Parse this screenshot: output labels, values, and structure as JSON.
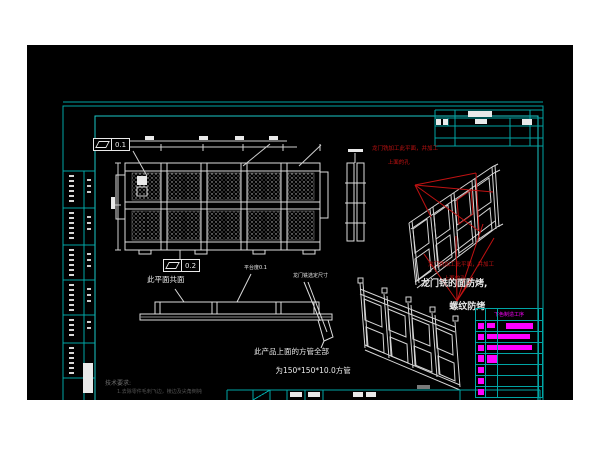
{
  "app": {
    "description": "CAD engineering drawing canvas (gantry-milled welded platform frame)"
  },
  "colors": {
    "canvas_bg": "#000000",
    "sheet_frame": "#00a5a5",
    "inner_frame": "#1ac9c9",
    "linework": "#e9e9e9",
    "annotation_red": "#c01212",
    "process_magenta": "#ff00ff",
    "tech_note_gray": "#6f6f6f"
  },
  "gdt": {
    "flatness_top": "0.1",
    "flatness_mid": "0.2"
  },
  "notes": {
    "coplanar": "此平面共面",
    "platform_flatness": "平台度0.1",
    "gantry_dim": "龙门铣选定尺寸",
    "red_note_line1": "龙门铣加工此平面，并加工",
    "red_note_line2": "上面的孔",
    "face_note_line1": "龙门铣的面防烤,",
    "face_note_line2": "螺纹防烤",
    "tube_note_line1": "此产品上面的方管全部",
    "tube_note_line2": "为150*150*10.0方管",
    "tech_req_title": "技术要求:",
    "tech_req_line": "1.去除零件毛刺飞边，棱边及尖角倒钝"
  },
  "process_table": {
    "header": "下色制造工序",
    "rows": [
      {
        "bars": [
          {
            "x": 2,
            "y": 2,
            "w": 6,
            "h": 6
          },
          {
            "x": 11,
            "y": 2,
            "w": 8,
            "h": 5
          },
          {
            "x": 30,
            "y": 2,
            "w": 27,
            "h": 6
          }
        ]
      },
      {
        "bars": [
          {
            "x": 2,
            "y": 2,
            "w": 6,
            "h": 6
          },
          {
            "x": 11,
            "y": 2,
            "w": 43,
            "h": 5
          }
        ]
      },
      {
        "bars": [
          {
            "x": 2,
            "y": 2,
            "w": 6,
            "h": 6
          },
          {
            "x": 11,
            "y": 2,
            "w": 45,
            "h": 5
          }
        ]
      },
      {
        "bars": [
          {
            "x": 2,
            "y": 1,
            "w": 6,
            "h": 7
          },
          {
            "x": 11,
            "y": 1,
            "w": 10,
            "h": 8
          }
        ]
      },
      {
        "bars": [
          {
            "x": 2,
            "y": 2,
            "w": 6,
            "h": 6
          }
        ]
      },
      {
        "bars": [
          {
            "x": 2,
            "y": 2,
            "w": 6,
            "h": 6
          }
        ]
      },
      {
        "bars": [
          {
            "x": 2,
            "y": 2,
            "w": 6,
            "h": 6
          }
        ]
      }
    ]
  }
}
